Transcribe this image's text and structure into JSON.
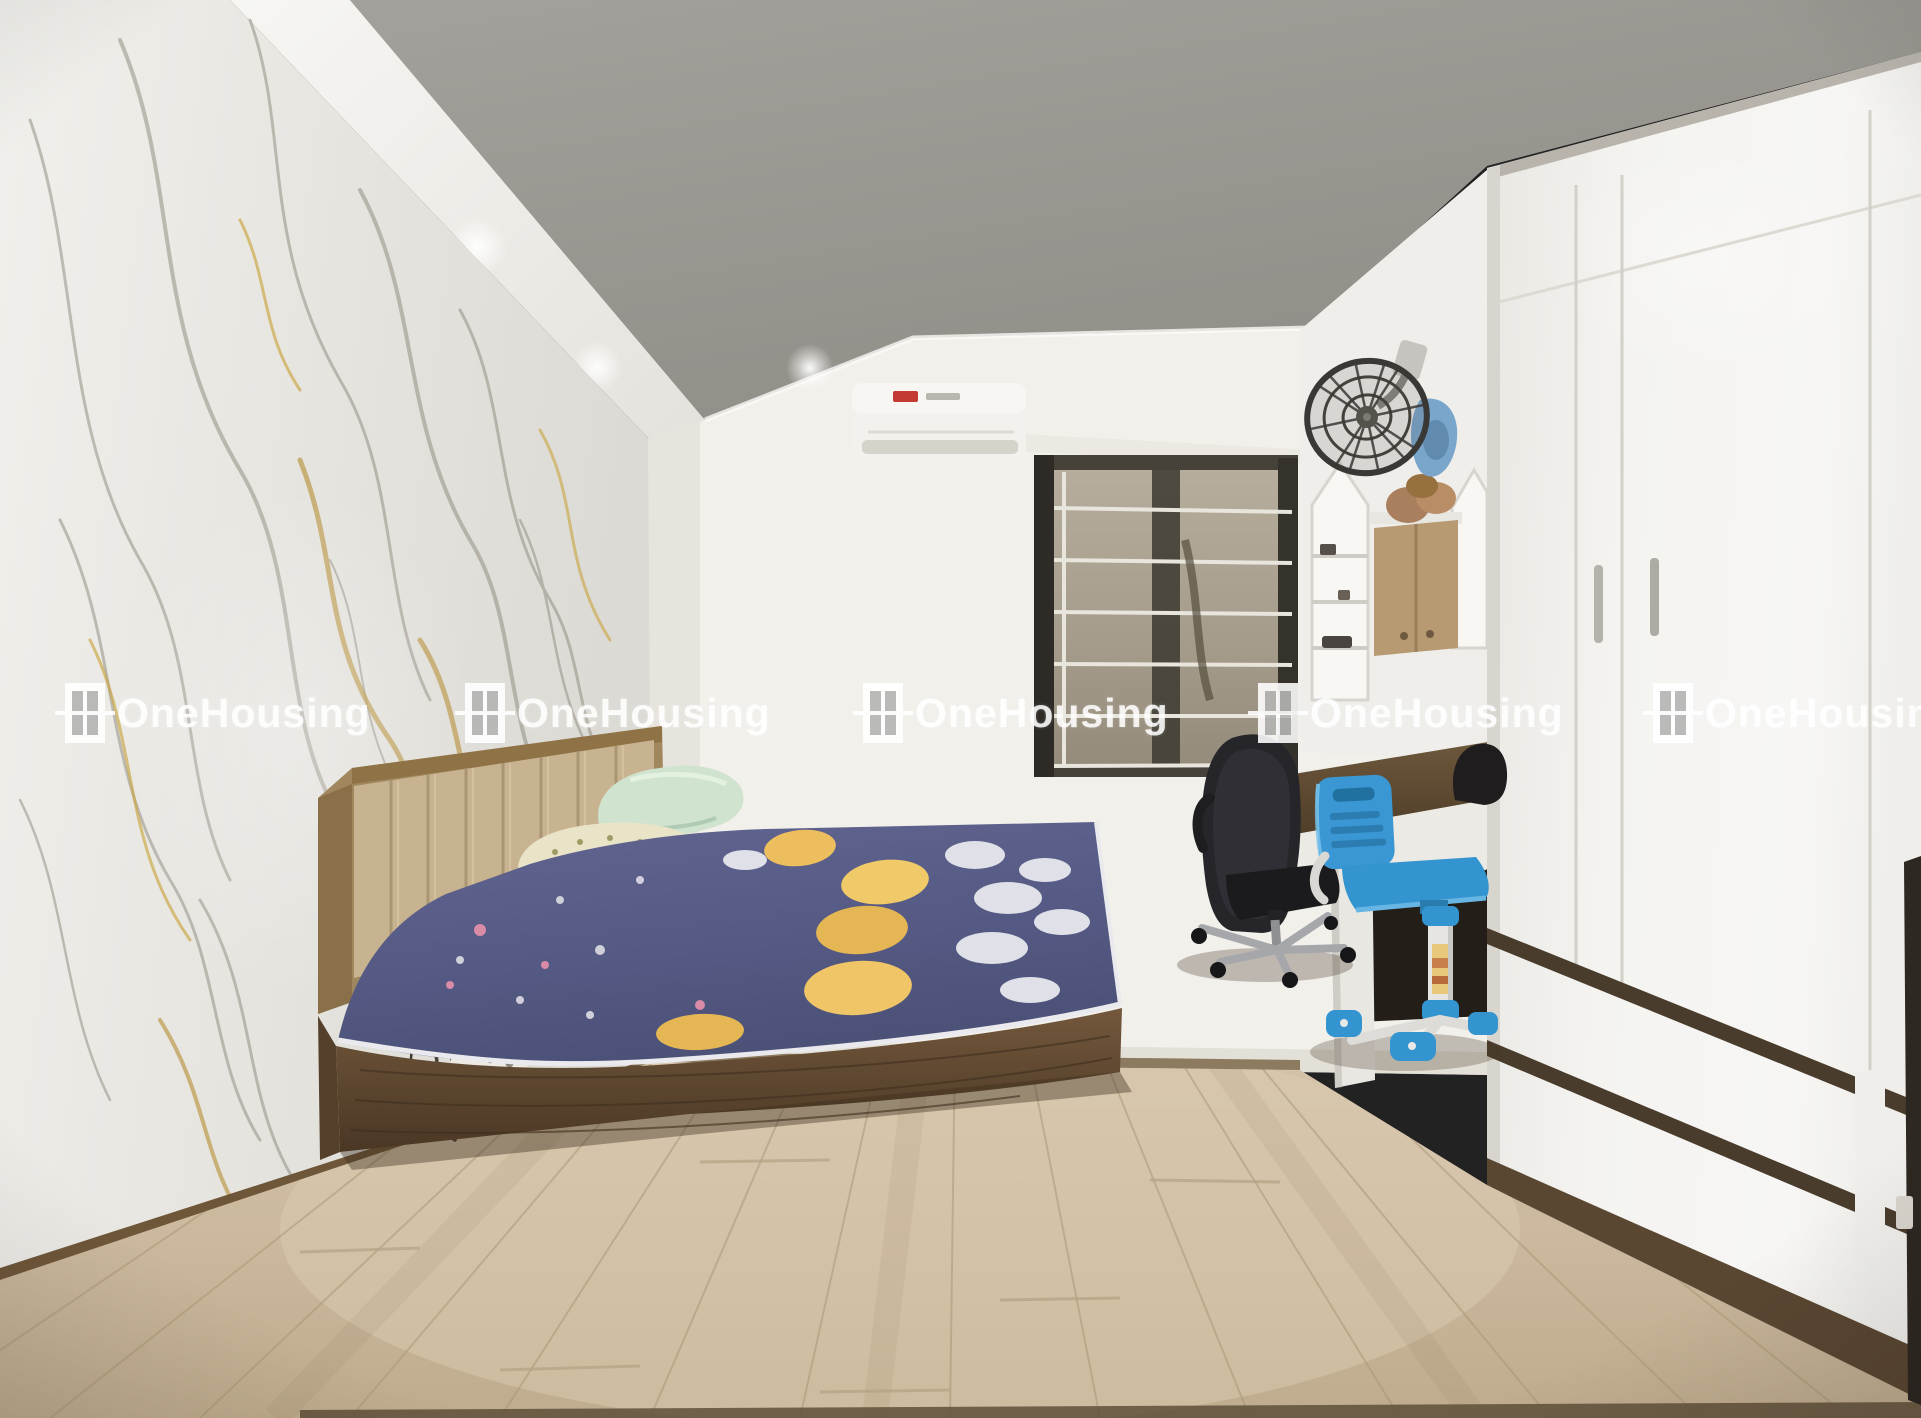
{
  "watermark": {
    "text": "OneHousing",
    "count": 5,
    "color": "#ffffff",
    "logo": "window-logo"
  },
  "palette": {
    "ceiling_gray": "#98968f",
    "soffit_white": "#f3f2ee",
    "marble_base": "#eceae5",
    "marble_vein_gray": "#8c887c",
    "marble_vein_gold": "#b8933f",
    "back_wall": "#f2f0ec",
    "window_frame": "#46423a",
    "window_bars": "#e8e5dd",
    "ac_body": "#f2f1ed",
    "ac_badge_red": "#c23a33",
    "fan_cage": "#3a3835",
    "desk_wood": "#64513a",
    "office_chair_black": "#242427",
    "kids_chair_blue": "#3a97d3",
    "wardrobe_white": "#f2f1ee",
    "bed_wood": "#6b533a",
    "headboard_tan": "#c8b391",
    "mattress_navy": "#565b86",
    "moon_yellow": "#ecbe5e",
    "pillow_mint": "#cfe3cf",
    "pillow_floral": "#e9e4c8",
    "floor_wood": "#c9b69c"
  },
  "scene_objects": [
    "marble-accent-wall",
    "tray-ceiling",
    "recessed-lights",
    "air-conditioner",
    "window-with-grille",
    "wall-fan",
    "arched-shelf-niches",
    "wall-cabinet",
    "study-desk",
    "office-chair",
    "kids-desk-chair",
    "built-in-wardrobe",
    "bed",
    "upholstered-headboard",
    "pillows",
    "mattress-with-moon-bedsheet",
    "power-outlet",
    "power-strip",
    "wood-floor"
  ]
}
